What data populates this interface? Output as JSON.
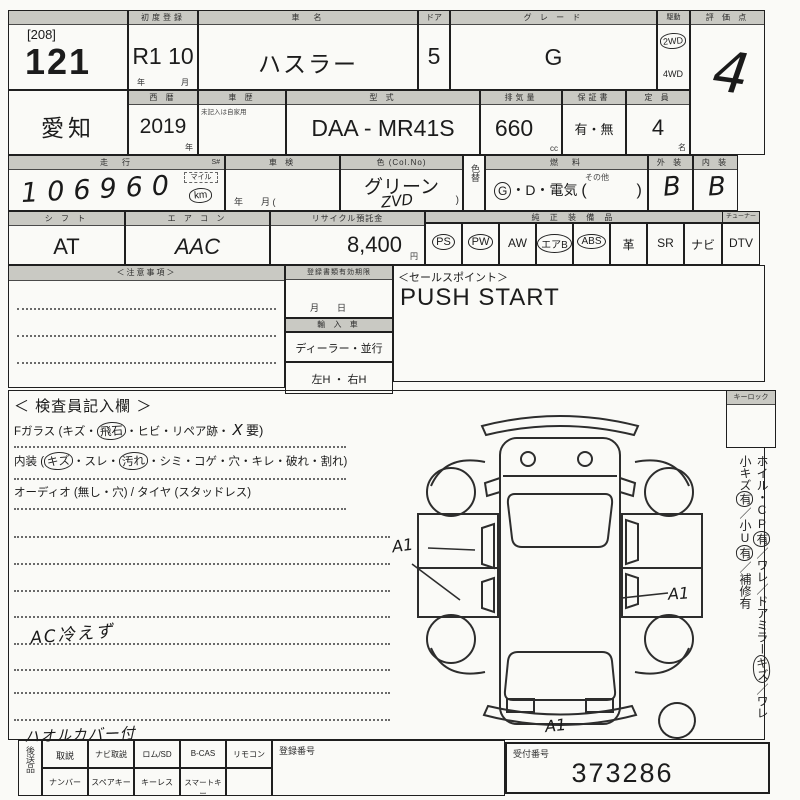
{
  "colors": {
    "paper": "#fafaf7",
    "header_bg": "#c9c9c3",
    "ink": "#1c1c1c",
    "hand_ink": "#1a1a1a"
  },
  "sheet": {
    "row1": {
      "lot_group": "[208]",
      "lot_no": "121",
      "first_reg_header": "初度登録",
      "first_reg": "R1  10",
      "first_reg_unit_year": "年",
      "first_reg_unit_month": "月",
      "car_name_header": "車　名",
      "car_name": "ハスラー",
      "door_header": "ドア",
      "door": "5",
      "grade_header": "グ レ ー ド",
      "grade": "G",
      "drive_header": "駆動",
      "drive_2wd": "2WD",
      "drive_4wd": "4WD",
      "score_header": "評 価 点",
      "score": "4"
    },
    "row2": {
      "prefecture": "愛知",
      "year_header": "西 暦",
      "year": "2019",
      "year_unit": "年",
      "history_header": "車 歴",
      "history_note": "未記入は自家用",
      "model_header": "型 式",
      "model": "DAA - MR41S",
      "displacement_header": "排気量",
      "displacement": "660",
      "displacement_unit": "cc",
      "warranty_header": "保証書",
      "warranty": "有・無",
      "capacity_header": "定 員",
      "capacity": "4",
      "capacity_unit": "名"
    },
    "row3": {
      "mileage_header": "走　行",
      "mileage_s": "S#",
      "mileage": "106960",
      "mile_unit": "マイル",
      "km_unit": "km",
      "inspection_header": "車 検",
      "inspection_units": "年　　月 (",
      "color_header": "色 (Col.No)",
      "color": "グリーン",
      "color_code": "ZVD",
      "color_paren": ")",
      "color_change_header": "色替",
      "fuel_header": "燃　料",
      "fuel_g": "G",
      "fuel_rest": "・D・電気",
      "fuel_open": "(",
      "fuel_other": "その他",
      "fuel_close": ")",
      "exterior_header": "外 装",
      "exterior": "B",
      "interior_header": "内 装",
      "interior": "B"
    },
    "row4": {
      "shift_header": "シ フ ト",
      "shift": "AT",
      "aircon_header": "エ ア コ ン",
      "aircon": "AAC",
      "recycle_header": "リサイクル預託金",
      "recycle": "8,400",
      "recycle_unit": "円",
      "equipment_header": "純 正 装 備 品",
      "tuner_header": "チューナー",
      "equipment": [
        {
          "label": "PS",
          "circled": true
        },
        {
          "label": "PW",
          "circled": true
        },
        {
          "label": "AW",
          "circled": false
        },
        {
          "label": "エアB",
          "circled": true
        },
        {
          "label": "ABS",
          "circled": true
        },
        {
          "label": "革",
          "circled": false
        },
        {
          "label": "SR",
          "circled": false
        },
        {
          "label": "ナビ",
          "circled": false
        },
        {
          "label": "DTV",
          "circled": false
        }
      ]
    },
    "row5": {
      "notes_header": "＜注意事項＞",
      "docs_header": "登録書類有効期限",
      "docs_units": "月　　日",
      "import_header": "輸 入 車",
      "import_options": "ディーラー・並行",
      "handle_options": "左H ・ 右H",
      "sales_header": "＜セールスポイント＞",
      "sales_point": "PUSH START"
    },
    "inspector": {
      "header": "＜ 検査員記入欄 ＞",
      "glass_pre": "Fガラス (キズ・",
      "glass_circled": "飛石",
      "glass_mid": "・ヒビ・リペア跡・",
      "glass_x": "X",
      "glass_end": "要)",
      "interior_pre": "内装 (",
      "interior_c1": "キズ",
      "interior_m1": "・スレ・",
      "interior_c2": "汚れ",
      "interior_m2": "・シミ・コゲ・穴・キレ・破れ・割れ)",
      "audio_line": "オーディオ (無し・穴) / タイヤ (スタッドレス)",
      "note_ac": "AC冷えず",
      "note_cover": "ハオルカバー付"
    },
    "right_panel": {
      "keylock_header": "キーロック",
      "side1_pre": "ホイル・CP",
      "side1_c": "有",
      "side1_post": "／ワレ／",
      "side2_pre": "ドアミラー",
      "side2_c": "キズ",
      "side2_post": "／ワレ",
      "side3_pre": "小キズ",
      "side3_c1": "有",
      "side3_mid": "／小U",
      "side3_c2": "有",
      "side3_post": "／補修有"
    },
    "diagram": {
      "mark_left": "A1",
      "mark_right": "A1",
      "mark_bottom": "A1"
    },
    "row7": {
      "send_label": "後送品",
      "top_cells": [
        "取説",
        "ナビ取説",
        "ロム/SD",
        "B-CAS",
        "リモコン"
      ],
      "bottom_cells": [
        "ナンバー",
        "スペアキー",
        "キーレス",
        "スマートキー"
      ],
      "reg_header": "登録番号",
      "receipt_header": "受付番号",
      "receipt_no": "373286"
    }
  }
}
